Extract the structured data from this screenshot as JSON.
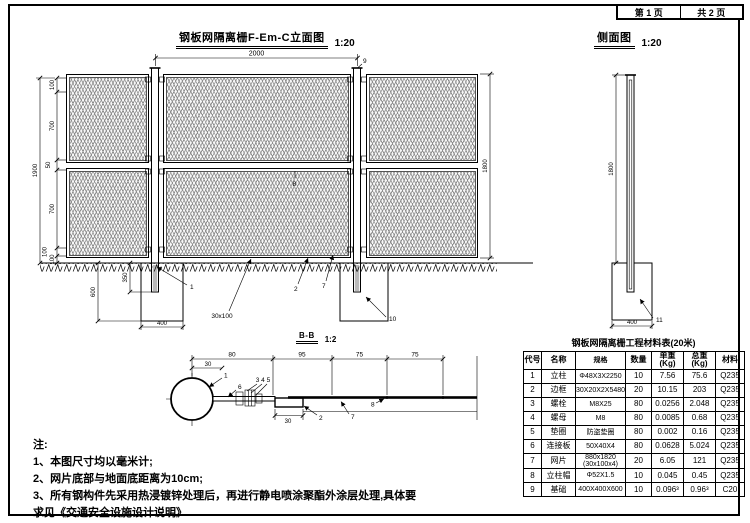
{
  "page": {
    "sheet_no": "第 1 页",
    "sheet_total": "共 2 页"
  },
  "titles": {
    "front": {
      "text": "钢板网隔离栅F-Em-C立面图",
      "scale": "1:20"
    },
    "side": {
      "text": "侧面图",
      "scale": "1:20"
    },
    "section": {
      "text": "B-B",
      "scale": "1:2"
    }
  },
  "elevation": {
    "span": "2000",
    "height_total": "1900",
    "height_right": "1800",
    "seg1": "100",
    "seg2": "700",
    "seg3": "50",
    "seg4": "700",
    "seg5": "100",
    "seg6": "100",
    "embed": "350",
    "depth": "600",
    "found_w": "400",
    "mesh_size": "30x100",
    "lbl_post": "1",
    "lbl_frame": "2",
    "lbl_mesh": "8",
    "lbl_cap": "9",
    "lbl_found": "10"
  },
  "side": {
    "height": "1800",
    "found_w": "400",
    "lbl_found": "11"
  },
  "section": {
    "d_30a": "30",
    "d_80": "80",
    "d_95": "95",
    "d_75a": "75",
    "d_75b": "75",
    "d_30b": "30",
    "lbl_post": "1",
    "lbl_plate": "6",
    "lbl_bolts": "3 4 5",
    "lbl_frame": "2",
    "lbl_mesh": "7",
    "lbl_8": "8"
  },
  "notes": {
    "title": "注:",
    "n1": "1、本图尺寸均以毫米计;",
    "n2": "2、网片底部与地面底距离为10cm;",
    "n3": "3、所有钢构件先采用热浸镀锌处理后，再进行静电喷涂聚酯外涂层处理,具体要",
    "n4": "求见《交通安全设施设计说明》."
  },
  "table": {
    "title": "钢板网隔离栅工程材料表(20米)",
    "headers": [
      "代号",
      "名称",
      "规格",
      "数量",
      "单重(Kg)",
      "总重(Kg)",
      "材料"
    ],
    "rows": [
      [
        "1",
        "立柱",
        "Φ48X3X2250",
        "10",
        "7.56",
        "75.6",
        "Q235"
      ],
      [
        "2",
        "边框",
        "30X20X2X5480",
        "20",
        "10.15",
        "203",
        "Q235"
      ],
      [
        "3",
        "螺栓",
        "M8X25",
        "80",
        "0.0256",
        "2.048",
        "Q235"
      ],
      [
        "4",
        "螺母",
        "M8",
        "80",
        "0.0085",
        "0.68",
        "Q235"
      ],
      [
        "5",
        "垫圈",
        "防盗垫圈",
        "80",
        "0.002",
        "0.16",
        "Q235"
      ],
      [
        "6",
        "连接板",
        "50X40X4",
        "80",
        "0.0628",
        "5.024",
        "Q235"
      ],
      [
        "7",
        "网片",
        "880x1820\n(30x100x4)",
        "20",
        "6.05",
        "121",
        "Q235"
      ],
      [
        "8",
        "立柱帽",
        "Φ52X1.5",
        "10",
        "0.045",
        "0.45",
        "Q235"
      ],
      [
        "9",
        "基础",
        "400X400X600",
        "10",
        "0.096³",
        "0.96³",
        "C20"
      ]
    ]
  }
}
